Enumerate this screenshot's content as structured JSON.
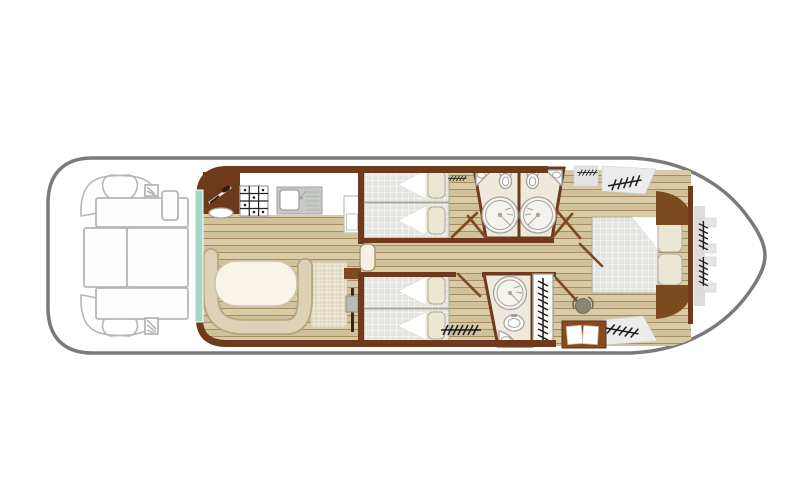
{
  "document_title": "Boat deck plan",
  "canvas": {
    "width": 810,
    "height": 500
  },
  "palette": {
    "hull_line": "#7a7a7a",
    "deck_line": "#b6b6b6",
    "wall": "#6e3a1b",
    "wood_accent": "#7c4a1e",
    "plank_a": "#d9cba6",
    "plank_b": "#d0c19a",
    "plank_line": "#a78d66",
    "mattress": "#e3e3df",
    "pillow": "#ece6d5",
    "pillow_edge": "#b0aa98",
    "bench": "#ddd2b6",
    "bench_edge": "#b5a47f",
    "table": "#f8f4ea",
    "table_edge": "#d0c3a6",
    "teal": "#a5d8c3",
    "bath_floor": "#efe9dc",
    "fixture": "#a3a39b",
    "hatch_bg": "#e4e4e2",
    "hatch_line": "#1d1d1d",
    "tile_a": "#e7dfc9",
    "tile_line": "#cfc4a6",
    "desk": "#8a4a21",
    "desk_edge": "#5d3312",
    "paper": "#ffffff",
    "steel": "#c7c9c6",
    "stove_line": "#222222",
    "stool": "#8b8674",
    "door_leaf": "#f6f1e4",
    "white": "#ffffff"
  },
  "areas": [
    {
      "name": "aft deck",
      "furniture": [
        "corner seat x4",
        "deck table",
        "sun pads",
        "side step",
        "vent grilles"
      ]
    },
    {
      "name": "saloon and galley",
      "furniture": [
        "counter",
        "stove",
        "sink with drainer",
        "cupboard",
        "u-shaped dinette bench",
        "oval table",
        "tiled area",
        "shelf",
        "heater"
      ]
    },
    {
      "name": "port twin cabin",
      "furniture": [
        "twin bed x2",
        "pillows",
        "wardrobe hatch"
      ]
    },
    {
      "name": "starboard twin cabin",
      "furniture": [
        "twin bed x2",
        "pillows",
        "wardrobe hatch"
      ]
    },
    {
      "name": "shower rooms",
      "furniture": [
        "round shower x3",
        "washbasin x3",
        "toilet x3",
        "tall wardrobe"
      ]
    },
    {
      "name": "central corridor",
      "furniture": [
        "door"
      ]
    },
    {
      "name": "bow master cabin",
      "furniture": [
        "double bed",
        "pillows",
        "headboard",
        "wardrobes",
        "desk",
        "stool"
      ]
    },
    {
      "name": "bow deck",
      "furniture": [
        "storage lockers"
      ]
    }
  ]
}
